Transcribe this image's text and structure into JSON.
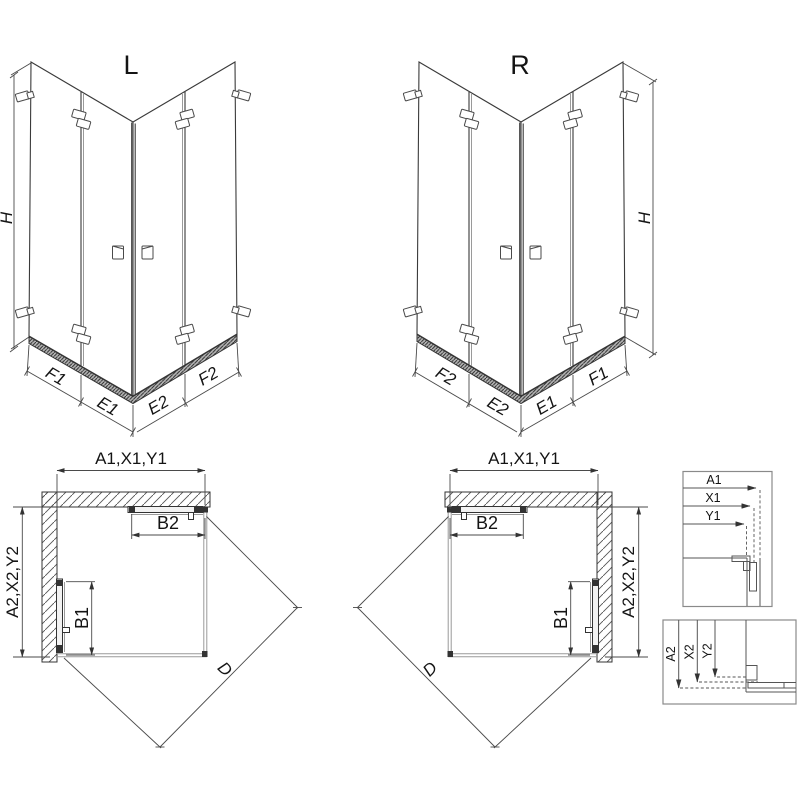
{
  "figure": {
    "iso_left": {
      "title": "L",
      "height_label": "H",
      "segment_labels": [
        "F1",
        "E1",
        "E2",
        "F2"
      ]
    },
    "iso_right": {
      "title": "R",
      "height_label": "H",
      "segment_labels": [
        "F2",
        "E2",
        "E1",
        "F1"
      ]
    },
    "plan_left": {
      "width_label": "A1,X1,Y1",
      "depth_label": "A2,X2,Y2",
      "door_front_label": "B2",
      "door_side_label": "B1",
      "diagonal_label": "D"
    },
    "plan_right": {
      "width_label": "A1,X1,Y1",
      "depth_label": "A2,X2,Y2",
      "door_front_label": "B2",
      "door_side_label": "B1",
      "diagonal_label": "D"
    },
    "detail_width": {
      "labels": [
        "A1",
        "X1",
        "Y1"
      ]
    },
    "detail_depth": {
      "labels": [
        "A2",
        "X2",
        "Y2"
      ]
    }
  },
  "colors": {
    "line": "#3a3a3a",
    "glass_edge": "#9a9a9a",
    "rail_fill": "#b5b5b5",
    "background": "#ffffff"
  }
}
